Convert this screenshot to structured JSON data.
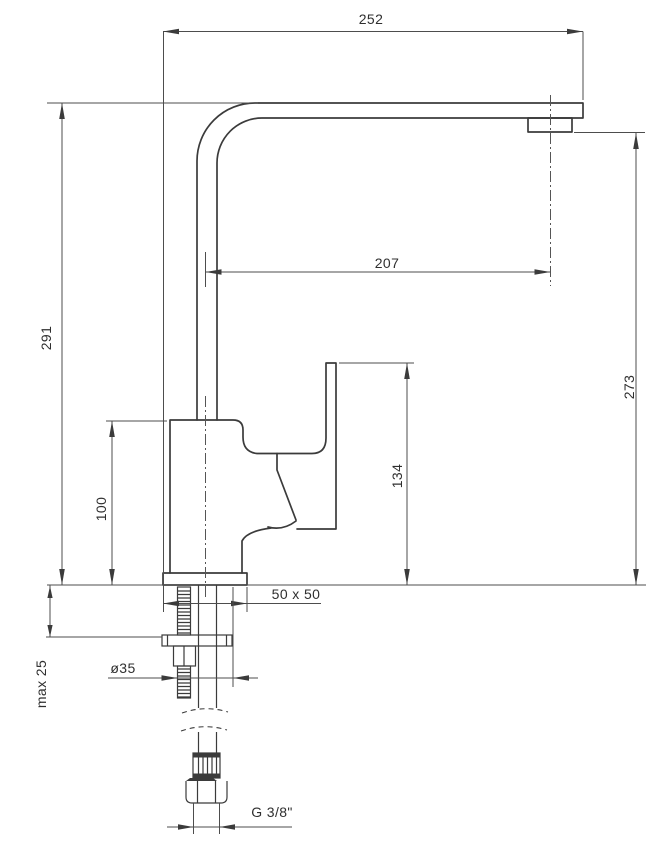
{
  "drawing": {
    "title": "faucet-technical-drawing",
    "background_color": "#ffffff",
    "line_color": "#3b3b3b",
    "dimensions": {
      "spout_width": "252",
      "spout_reach": "207",
      "height_total": "291",
      "height_spout_outlet": "273",
      "height_lever_top": "134",
      "height_body": "100",
      "base_footprint": "50 x 50",
      "mounting_hole_diameter": "ø35",
      "max_deck_thickness": "max 25",
      "connection_thread": "G 3/8\""
    }
  }
}
